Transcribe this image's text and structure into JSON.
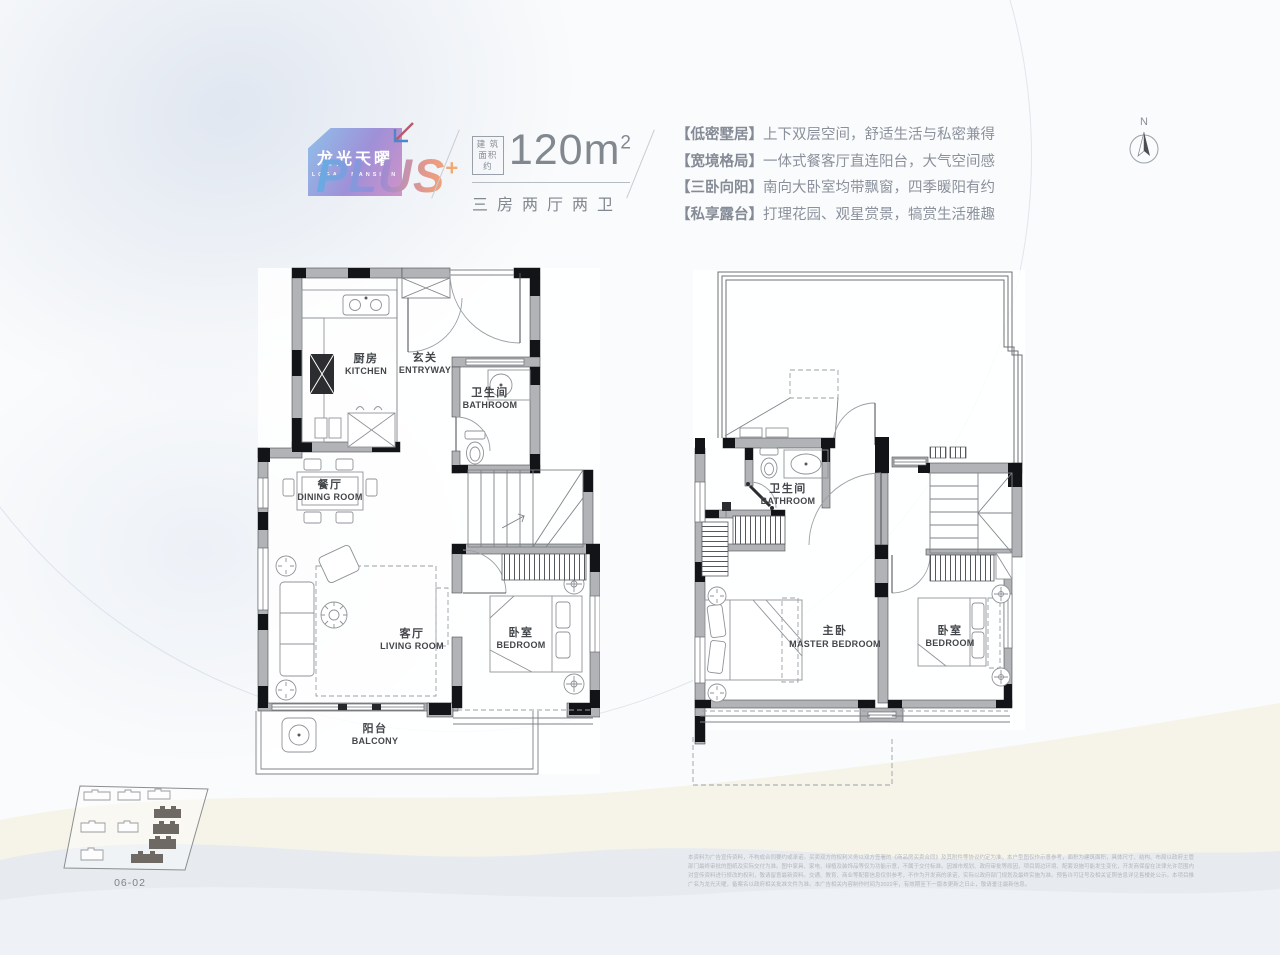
{
  "header": {
    "logo": {
      "brand_cn": "龙光天曜",
      "brand_en": "LOGAN MANSION",
      "plus": "PLUS",
      "plus_sup": "+"
    },
    "area": {
      "label_top": "建 筑",
      "label_bottom": "面积约",
      "value": "120m",
      "value_sup": "2",
      "layout": "三房两厅两卫"
    },
    "features": [
      {
        "tag": "【低密墅居】",
        "text": "上下双层空间，舒适生活与私密兼得"
      },
      {
        "tag": "【宽境格局】",
        "text": "一体式餐客厅直连阳台，大气空间感"
      },
      {
        "tag": "【三卧向阳】",
        "text": "南向大卧室均带飘窗，四季暖阳有约"
      },
      {
        "tag": "【私享露台】",
        "text": "打理花园、观星赏景，犒赏生活雅趣"
      }
    ],
    "compass": {
      "label": "N"
    }
  },
  "plans": {
    "lower": {
      "rooms": {
        "kitchen": {
          "cn": "厨房",
          "en": "KITCHEN"
        },
        "entryway": {
          "cn": "玄关",
          "en": "ENTRYWAY"
        },
        "bathroom": {
          "cn": "卫生间",
          "en": "BATHROOM"
        },
        "dining": {
          "cn": "餐厅",
          "en": "DINING ROOM"
        },
        "living": {
          "cn": "客厅",
          "en": "LIVING ROOM"
        },
        "bedroom": {
          "cn": "卧室",
          "en": "BEDROOM"
        },
        "balcony": {
          "cn": "阳台",
          "en": "BALCONY"
        }
      }
    },
    "upper": {
      "rooms": {
        "bathroom": {
          "cn": "卫生间",
          "en": "BATHROOM"
        },
        "master": {
          "cn": "主卧",
          "en": "MASTER BEDROOM"
        },
        "bedroom": {
          "cn": "卧室",
          "en": "BEDROOM"
        }
      }
    }
  },
  "sitemap": {
    "unit_label": "06-02"
  },
  "disclaimer": {
    "text": "本资料为广告宣传资料，不构成合同要约或承诺。买卖双方的权利义务以双方签署的《商品房买卖合同》及其附件等协议约定为准。本户型图仅作示意参考，面积为建筑面积，具体尺寸、结构、布局以政府主管部门最终审批的图纸及实际交付为准。图中家具、家电、绿植及装饰品等仅为功能示意，不属于交付标准。因城市规划、政府审批等原因，项目周边环境、配套设施可能发生变化，开发商保留在法律允许范围内对宣传资料进行修改的权利，敬请留意最新资料。交通、教育、商业等配套信息仅供参考，不作为开发商的承诺，实际以政府部门规划及最终实施为准。预售许可证号及相关证照信息详见售楼处公示。本项目推广名为龙光天曜，备案名以政府相关批准文件为准。本广告相关内容制作时间为2022年，有效期至下一版本更新之日止，敬请垂注最新信息。"
  },
  "colors": {
    "logo_gradient": [
      "#8fc0ea",
      "#9f90d8",
      "#d093c8"
    ],
    "plus_gradient": [
      "#6aaae2",
      "#9b8ad8",
      "#e89a86",
      "#f3b06e"
    ],
    "wall_gray": "#b2b3b6",
    "wall_black": "#131417",
    "hill_cream": "#f4f1e3",
    "hill_blue": "#e3e9f0"
  }
}
